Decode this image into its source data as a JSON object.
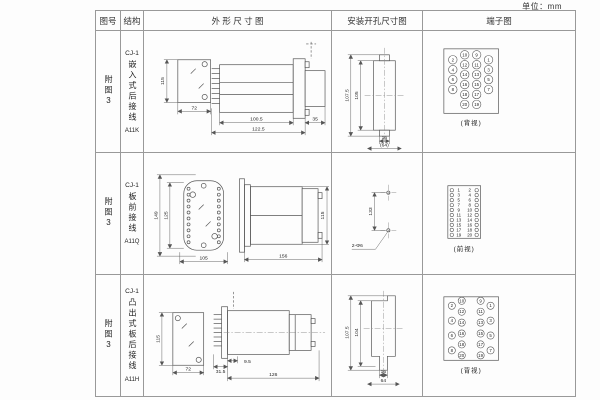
{
  "page": {
    "unit": "单位：mm"
  },
  "header": {
    "fig_no": "图号",
    "structure": "结构",
    "outline": "外 形 尺 寸 图",
    "mounting": "安装开孔尺寸图",
    "terminal": "端子图"
  },
  "rows": [
    {
      "fig_no": "附图3",
      "model": "CJ-1",
      "structure_text": "嵌入式后接线",
      "code": "A11K",
      "outline": {
        "height": "115",
        "width": "72",
        "body": "100.5",
        "overall": "122.5",
        "rear": "35"
      },
      "mounting": {
        "outer": "107.5",
        "inner": "105",
        "slot": "16",
        "overall": "(64)"
      },
      "terminal": {
        "caption": "(背视)",
        "outer_left": [
          "2",
          "4",
          "6",
          "8"
        ],
        "inner_left": [
          "10",
          "12",
          "14",
          "16",
          "18",
          "20"
        ],
        "inner_right": [
          "9",
          "11",
          "13",
          "15",
          "17",
          "19"
        ],
        "outer_right": [
          "1",
          "3",
          "5",
          "7"
        ]
      }
    },
    {
      "fig_no": "附图3",
      "model": "CJ-1",
      "structure_text": "板前接线",
      "code": "A11Q",
      "outline": {
        "outer_h": "149",
        "inner_h": "125",
        "width": "105",
        "length": "156",
        "height": "115"
      },
      "mounting": {
        "pitch": "133",
        "holes": "2-Φ6"
      },
      "terminal": {
        "caption": "(前视)",
        "left": [
          "1",
          "3",
          "5",
          "7",
          "9",
          "11",
          "13",
          "15",
          "17",
          "19"
        ],
        "right": [
          "2",
          "4",
          "6",
          "8",
          "10",
          "12",
          "14",
          "16",
          "18",
          "20"
        ]
      }
    },
    {
      "fig_no": "附图3",
      "model": "CJ-1",
      "structure_text": "凸出式板后接线",
      "code": "A11H",
      "outline": {
        "height": "115",
        "width": "72",
        "front": "31.5",
        "step": "9.5",
        "length": "126"
      },
      "mounting": {
        "outer": "107.5",
        "inner": "104",
        "slot": "16",
        "overall": "64"
      },
      "terminal": {
        "caption": "(背视)",
        "outer_left": [
          "2",
          "4",
          "6",
          "8"
        ],
        "inner_left": [
          "10",
          "12",
          "14",
          "16",
          "18",
          "20"
        ],
        "inner_right": [
          "9",
          "11",
          "13",
          "15",
          "17",
          "19"
        ],
        "outer_right": [
          "1",
          "3",
          "5",
          "7"
        ]
      }
    }
  ]
}
